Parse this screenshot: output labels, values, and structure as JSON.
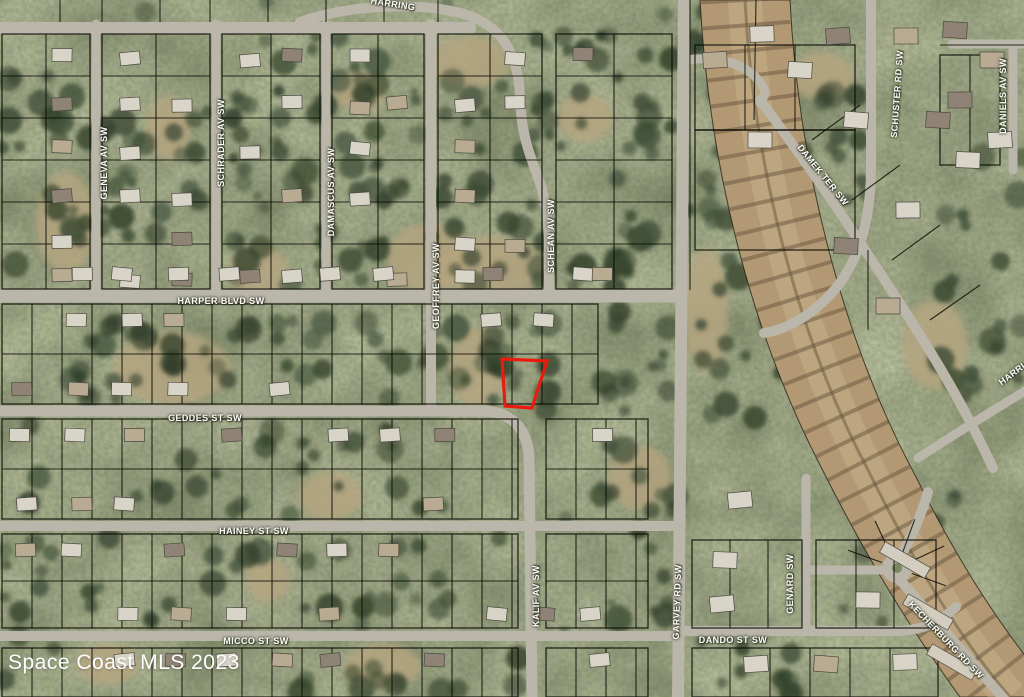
{
  "map": {
    "watermark": {
      "text": "Space Coast MLS 2023"
    },
    "subject_parcel": {
      "outline_color": "#ea1a0c",
      "points": "502,359 547,361 532,408 505,406"
    },
    "street_labels": [
      {
        "text": "HARRING"
      },
      {
        "text": "HARPER BLVD SW"
      },
      {
        "text": "GEDDES ST SW"
      },
      {
        "text": "HAINEY ST SW"
      },
      {
        "text": "MICCO ST SW"
      },
      {
        "text": "DANDO ST SW"
      },
      {
        "text": "GENEVA AV SW"
      },
      {
        "text": "SCHRADER AV SW"
      },
      {
        "text": "DAMASCUS AV SW"
      },
      {
        "text": "GEOFFREY AV SW"
      },
      {
        "text": "SCHEAN AV SW"
      },
      {
        "text": "KALIF AV SW"
      },
      {
        "text": "GARVEY RD SW"
      },
      {
        "text": "GENARD SW"
      },
      {
        "text": "SCHUSTER RD SW"
      },
      {
        "text": "DANIELS AV SW"
      },
      {
        "text": "DAMEK TER SW"
      },
      {
        "text": "KECHERBURG RD SW"
      },
      {
        "text": "HARRI"
      }
    ]
  }
}
